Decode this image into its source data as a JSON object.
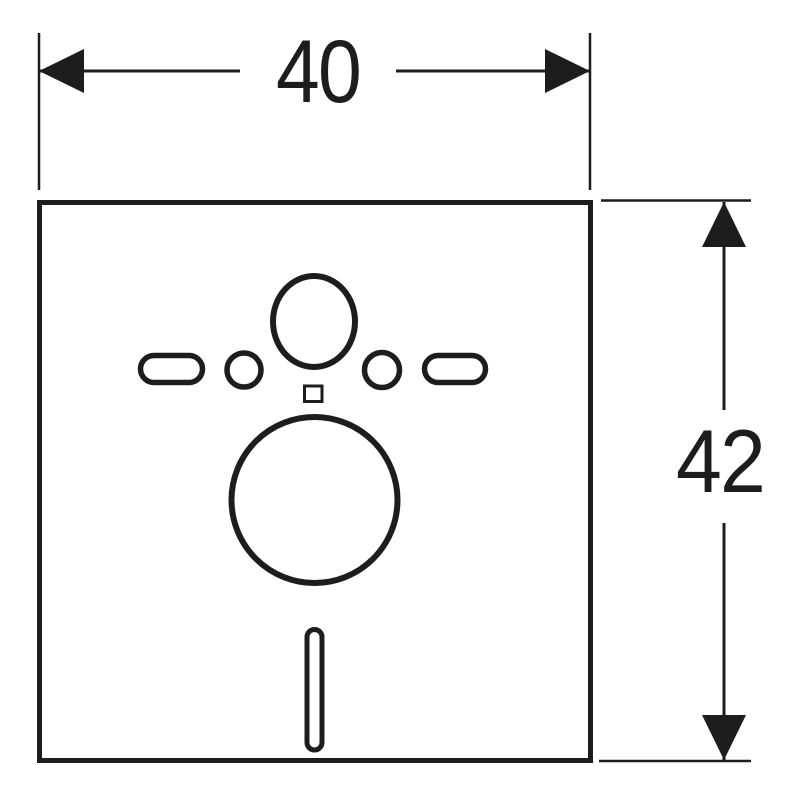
{
  "drawing": {
    "type": "technical-dimension-drawing",
    "subject": "sound-insulation-mat-with-cutouts",
    "background_color": "#ffffff",
    "line_color": "#1d1d1b",
    "dimensions": {
      "horizontal": {
        "label": "40"
      },
      "vertical": {
        "label": "42"
      }
    }
  }
}
